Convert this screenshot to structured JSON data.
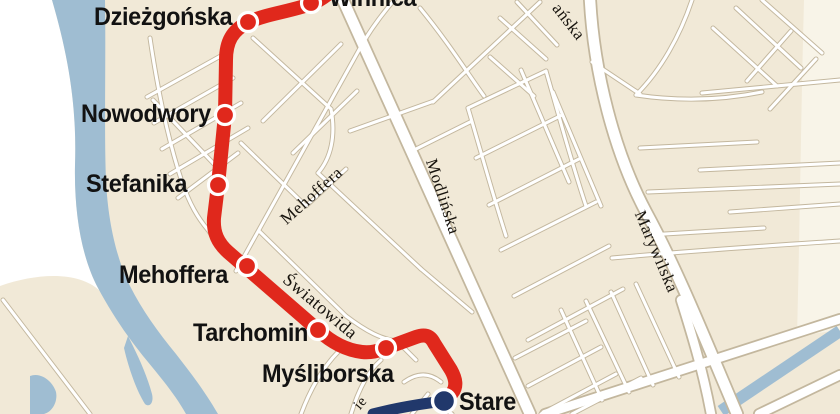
{
  "map": {
    "stops": [
      {
        "name": "Winnica"
      },
      {
        "name": "Dzieżgońska"
      },
      {
        "name": "Nowodwory"
      },
      {
        "name": "Stefanika"
      },
      {
        "name": "Mehoffera"
      },
      {
        "name": "Tarchomin"
      },
      {
        "name": "Myśliborska"
      },
      {
        "name": "Stare"
      }
    ],
    "street_labels": [
      {
        "name": "Mehoffera"
      },
      {
        "name": "Światowida"
      },
      {
        "name": "Modlińska"
      },
      {
        "name": "Marywilska"
      },
      {
        "name": "ańska"
      },
      {
        "name": "ie"
      }
    ],
    "colors": {
      "route_red": "#e0281c",
      "terminus_navy": "#21386b",
      "river_blue": "#9fbdd2",
      "land_beige": "#f1e9d7",
      "pale_band": "#f8f4e8",
      "road_casing": "#c3b79e",
      "label_black": "#141414",
      "bank_white": "#ffffff"
    }
  }
}
